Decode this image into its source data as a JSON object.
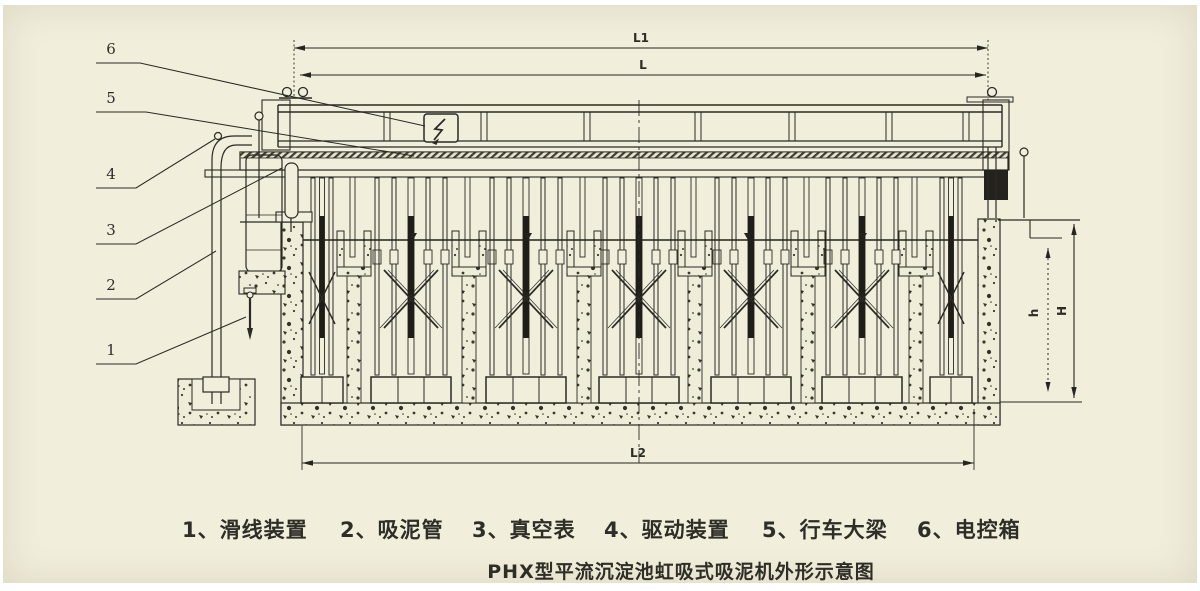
{
  "title": {
    "text": "PHX型平流沉淀池虹吸式吸泥机外形示意图"
  },
  "legend": {
    "items": [
      "1、滑线装置",
      "2、吸泥管",
      "3、真空表",
      "4、驱动装置",
      "5、行车大梁",
      "6、电控箱"
    ]
  },
  "callouts": {
    "labels": [
      "1",
      "2",
      "3",
      "4",
      "5",
      "6"
    ]
  },
  "dimensions": {
    "top_outer": "L1",
    "top_inner": "L",
    "bottom": "L2",
    "height_outer": "H",
    "height_inner": "h"
  },
  "icons": {
    "electric_box": "lightning-bolt-icon"
  },
  "colors": {
    "paper": "#f1eedc",
    "ink": "#2b2a24",
    "dark_fill": "#1e1d18",
    "concrete_speck": "#37362c"
  }
}
